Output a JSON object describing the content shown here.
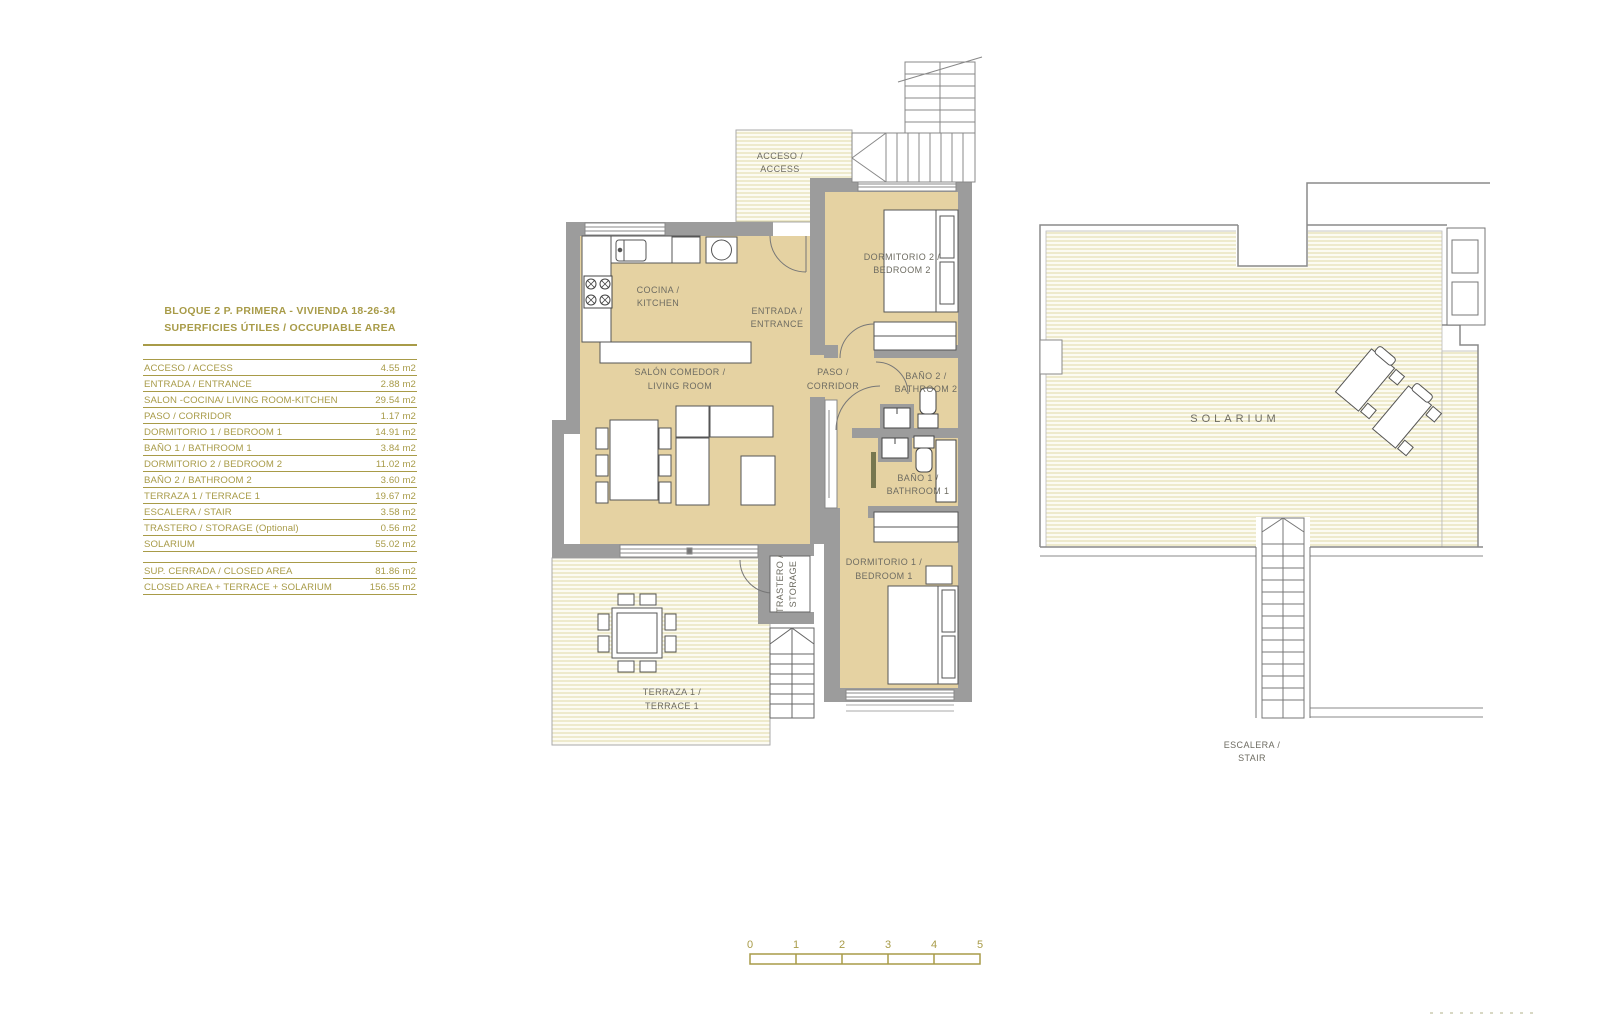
{
  "legend": {
    "title_line1": "BLOQUE 2  P. PRIMERA - VIVIENDA 18-26-34",
    "title_line2": "SUPERFICIES ÚTILES / OCCUPIABLE  AREA",
    "rows": [
      {
        "label": "ACCESO / ACCESS",
        "value": "4.55 m2"
      },
      {
        "label": "ENTRADA / ENTRANCE",
        "value": "2.88 m2"
      },
      {
        "label": "SALON -COCINA/ LIVING ROOM-KITCHEN",
        "value": "29.54 m2"
      },
      {
        "label": "PASO / CORRIDOR",
        "value": "1.17 m2"
      },
      {
        "label": "DORMITORIO 1 /  BEDROOM 1",
        "value": "14.91 m2"
      },
      {
        "label": "BAÑO 1 / BATHROOM 1",
        "value": "3.84 m2"
      },
      {
        "label": "DORMITORIO 2 / BEDROOM 2",
        "value": "11.02 m2"
      },
      {
        "label": "BAÑO 2 / BATHROOM 2",
        "value": "3.60 m2"
      },
      {
        "label": "TERRAZA 1 / TERRACE 1",
        "value": "19.67 m2"
      },
      {
        "label": "ESCALERA / STAIR",
        "value": "3.58 m2"
      },
      {
        "label": "TRASTERO / STORAGE (Optional)",
        "value": "0.56 m2"
      },
      {
        "label": "SOLARIUM",
        "value": "55.02 m2"
      }
    ],
    "summary": [
      {
        "label": "SUP. CERRADA / CLOSED AREA",
        "value": "81.86 m2"
      },
      {
        "label": "CLOSED AREA + TERRACE + SOLARIUM",
        "value": "156.55 m2"
      }
    ]
  },
  "plan": {
    "labels": {
      "acceso1": "ACCESO /",
      "acceso2": "ACCESS",
      "cocina1": "COCINA /",
      "cocina2": "KITCHEN",
      "entrada1": "ENTRADA /",
      "entrada2": "ENTRANCE",
      "salon1": "SALÓN COMEDOR /",
      "salon2": "LIVING ROOM",
      "paso1": "PASO /",
      "paso2": "CORRIDOR",
      "dorm2_1": "DORMITORIO 2 /",
      "dorm2_2": "BEDROOM 2",
      "bano2_1": "BAÑO 2 /",
      "bano2_2": "BATHROOM 2",
      "bano1_1": "BAÑO 1 /",
      "bano1_2": "BATHROOM 1",
      "dorm1_1": "DORMITORIO 1 /",
      "dorm1_2": "BEDROOM 1",
      "terraza1": "TERRAZA 1 /",
      "terraza2": "TERRACE 1",
      "trastero1": "TRASTERO /",
      "trastero2": "STORAGE",
      "solarium": "SOLARIUM",
      "escalera1": "ESCALERA /",
      "escalera2": "STAIR"
    }
  },
  "scalebar": {
    "ticks": [
      "0",
      "1",
      "2",
      "3",
      "4",
      "5"
    ]
  },
  "colors": {
    "gold": "#a89b48",
    "room_fill": "#e5d2a2",
    "wall_gray": "#9c9c9c",
    "label_gray": "#6e6c62",
    "hatch_line": "#e0d9a6"
  }
}
